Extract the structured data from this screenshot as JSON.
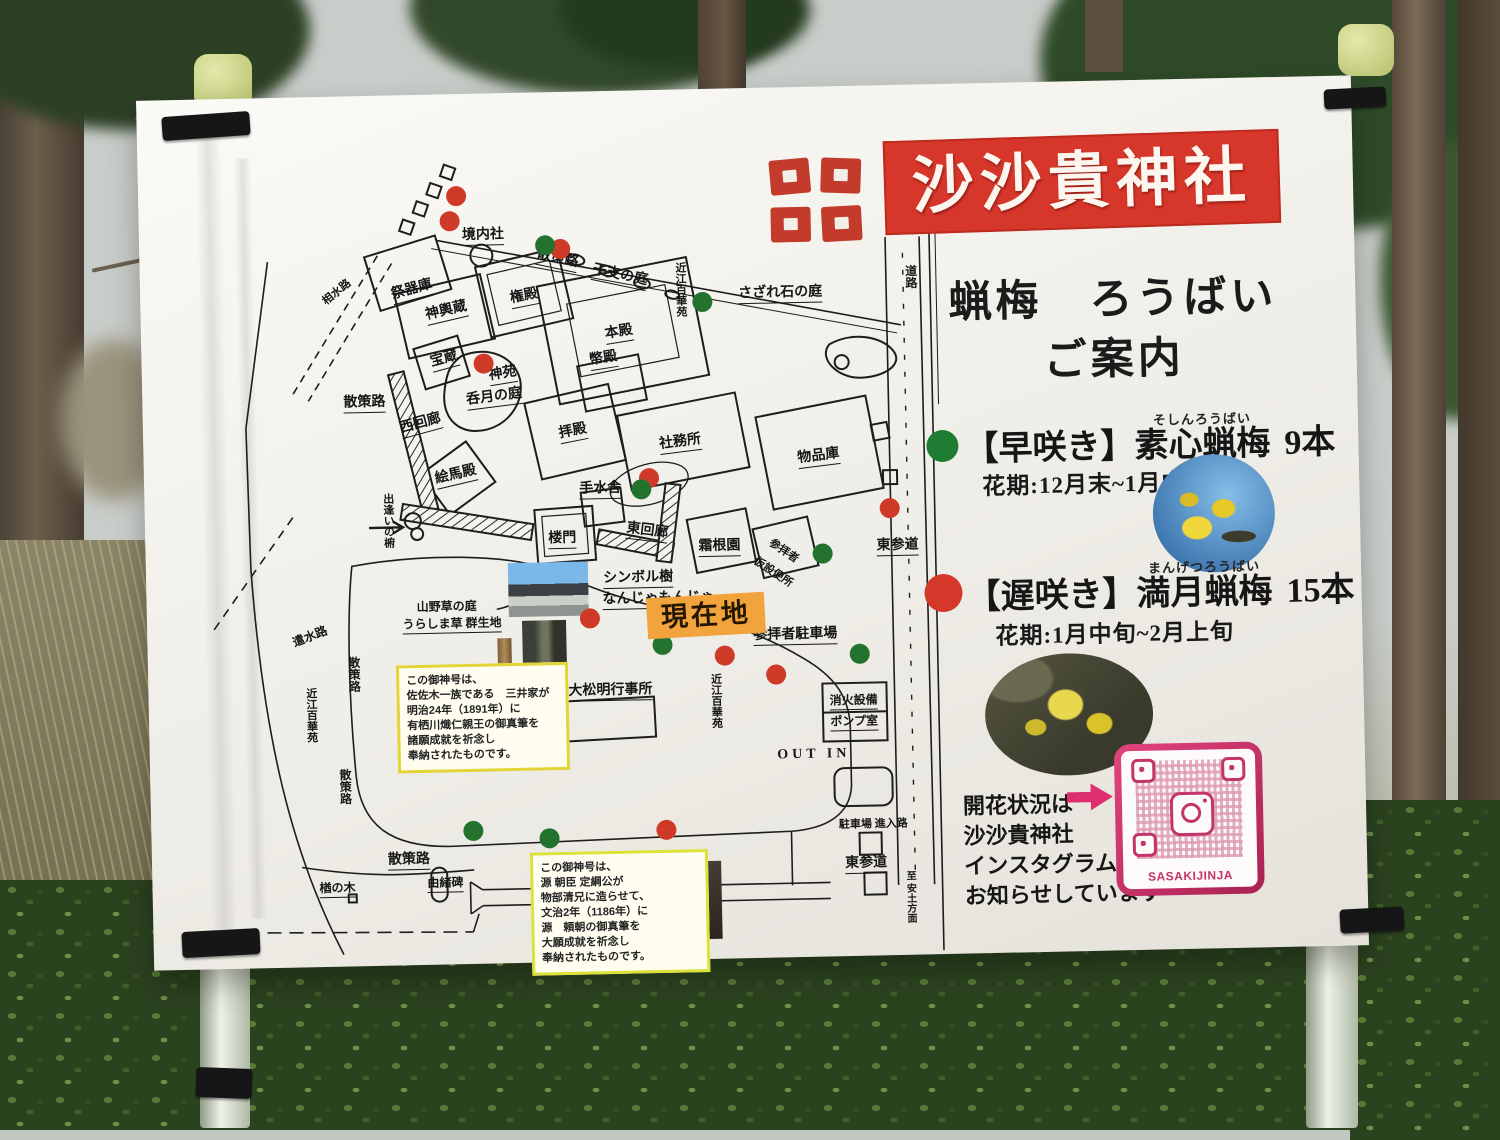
{
  "board": {
    "title": "沙沙貴神社",
    "guide_line1": "蝋梅　ろうばい",
    "guide_line2": "ご案内",
    "legend": [
      {
        "label": "【早咲き】",
        "name": "素心蝋梅",
        "furigana": "そしんろうばい",
        "count": "9本",
        "period": "花期:12月末~1月中旬",
        "dot_color": "#1e7d33"
      },
      {
        "label": "【遅咲き】",
        "name": "満月蝋梅",
        "furigana": "まんげつろうばい",
        "count": "15本",
        "period": "花期:1月中旬~2月上旬",
        "dot_color": "#d4382a"
      }
    ],
    "instagram": {
      "line1": "開花状況は",
      "line2": "沙沙貴神社",
      "line3": "インスタグラムで",
      "line4": "お知らせしています",
      "qr_caption": "SASAKIJINJA"
    },
    "colors": {
      "banner_red": "#d7362b",
      "accent_pink": "#dd2f6e",
      "marker_orange": "#f1a33c",
      "note_yellow": "#e3d437"
    }
  },
  "map": {
    "current_location": "現在地",
    "labels": [
      {
        "t": "祭器庫",
        "x": 272,
        "y": 196,
        "r": -14,
        "u": 1
      },
      {
        "t": "境内社",
        "x": 344,
        "y": 143,
        "u": 1
      },
      {
        "t": "散策路",
        "x": 418,
        "y": 168,
        "r": 13,
        "u": 1
      },
      {
        "t": "干支の庭",
        "x": 480,
        "y": 186,
        "r": 13,
        "u": 1
      },
      {
        "t": "近江百華苑",
        "x": 540,
        "y": 200,
        "v": 1,
        "s": 11
      },
      {
        "t": "さざれ石の庭",
        "x": 640,
        "y": 207,
        "u": 1
      },
      {
        "t": "神輿蔵",
        "x": 306,
        "y": 218,
        "r": -12,
        "u": 1
      },
      {
        "t": "権殿",
        "x": 384,
        "y": 205,
        "r": -10,
        "u": 1
      },
      {
        "t": "本殿",
        "x": 478,
        "y": 243,
        "r": -8,
        "u": 1
      },
      {
        "t": "幣殿",
        "x": 462,
        "y": 269,
        "r": -8,
        "u": 1
      },
      {
        "t": "宝蔵",
        "x": 303,
        "y": 266,
        "r": -14,
        "u": 1
      },
      {
        "t": "神苑",
        "x": 361,
        "y": 282,
        "r": -8,
        "u": 1
      },
      {
        "t": "呑月の庭",
        "x": 352,
        "y": 305,
        "r": -6,
        "u": 1
      },
      {
        "t": "西回廊",
        "x": 278,
        "y": 330,
        "r": -14,
        "u": 1
      },
      {
        "t": "散策路",
        "x": 222,
        "y": 308,
        "u": 1
      },
      {
        "t": "相水路",
        "x": 197,
        "y": 196,
        "r": -38,
        "s": 11
      },
      {
        "t": "拝殿",
        "x": 430,
        "y": 341,
        "r": -10,
        "u": 1
      },
      {
        "t": "絵馬殿",
        "x": 312,
        "y": 382,
        "r": -12,
        "u": 1
      },
      {
        "t": "手水舎",
        "x": 456,
        "y": 399,
        "u": 1
      },
      {
        "t": "社務所",
        "x": 537,
        "y": 354,
        "r": -6,
        "u": 1
      },
      {
        "t": "物品庫",
        "x": 675,
        "y": 371,
        "r": -6,
        "u": 1
      },
      {
        "t": "東回廊",
        "x": 502,
        "y": 442,
        "r": 8,
        "u": 1
      },
      {
        "t": "楼門",
        "x": 417,
        "y": 448,
        "u": 1
      },
      {
        "t": "霜根園",
        "x": 574,
        "y": 459,
        "u": 1
      },
      {
        "t": "参拝者",
        "x": 638,
        "y": 464,
        "r": 35,
        "s": 11
      },
      {
        "t": "仮設便所",
        "x": 627,
        "y": 485,
        "r": 35,
        "s": 11
      },
      {
        "t": "東参道",
        "x": 752,
        "y": 462,
        "u": 1
      },
      {
        "t": "シンボル樹",
        "x": 492,
        "y": 489,
        "u": 1
      },
      {
        "t": "なんじゃもんじゃ",
        "x": 512,
        "y": 510,
        "u": 1
      },
      {
        "t": "参拝者駐車場",
        "x": 648,
        "y": 549,
        "u": 1
      },
      {
        "t": "大松明行事所",
        "x": 462,
        "y": 601,
        "u": 1
      },
      {
        "t": "山野草の庭",
        "x": 300,
        "y": 513,
        "s": 12
      },
      {
        "t": "うらしま草 群生地",
        "x": 305,
        "y": 531,
        "s": 12,
        "u": 1
      },
      {
        "t": "出逢いの椨",
        "x": 243,
        "y": 425,
        "v": 1,
        "s": 11
      },
      {
        "t": "遣水路",
        "x": 163,
        "y": 540,
        "r": -20,
        "s": 12
      },
      {
        "t": "近江百華苑",
        "x": 162,
        "y": 618,
        "v": 1,
        "s": 11
      },
      {
        "t": "散策路",
        "x": 205,
        "y": 578,
        "v": 1,
        "s": 12
      },
      {
        "t": "散策路",
        "x": 194,
        "y": 690,
        "v": 1,
        "s": 12
      },
      {
        "t": "近江百華苑",
        "x": 567,
        "y": 612,
        "v": 1,
        "s": 11
      },
      {
        "t": "消火設備",
        "x": 705,
        "y": 616,
        "u": 1,
        "s": 12
      },
      {
        "t": "ポンプ室",
        "x": 705,
        "y": 637,
        "u": 1,
        "s": 12
      },
      {
        "t": "OUT IN",
        "x": 664,
        "y": 668,
        "s": 14,
        "sp": 1
      },
      {
        "t": "駐車場 進入路",
        "x": 722,
        "y": 739,
        "s": 11
      },
      {
        "t": "散策路",
        "x": 257,
        "y": 766,
        "u": 1
      },
      {
        "t": "楢の木",
        "x": 185,
        "y": 793,
        "u": 1,
        "s": 12
      },
      {
        "t": "由緒碑",
        "x": 293,
        "y": 790,
        "u": 1,
        "s": 12
      },
      {
        "t": "東参道",
        "x": 714,
        "y": 779,
        "u": 1
      },
      {
        "t": "道路",
        "x": 770,
        "y": 192,
        "v": 1,
        "s": 12
      },
      {
        "t": "至 安土方面",
        "x": 757,
        "y": 812,
        "v": 1,
        "s": 10
      }
    ],
    "notes": [
      {
        "lines": [
          "この御神号は、",
          "佐佐木一族である　三井家が",
          "明治24年（1891年）に",
          "有栖川熾仁親王の御真筆を",
          "諸願成就を祈念し",
          "奉納されたものです。"
        ]
      },
      {
        "lines": [
          "この御神号は、",
          "源 朝臣 定綱公が",
          "物部清兄に造らせて、",
          "文治2年（1186年）に",
          "源　頼朝の御真筆を",
          "大願成就を祈念し",
          "奉納されたものです。"
        ]
      }
    ],
    "dots": [
      {
        "x": 318,
        "y": 102,
        "c": "r"
      },
      {
        "x": 311,
        "y": 127,
        "c": "r"
      },
      {
        "x": 421,
        "y": 157,
        "c": "r"
      },
      {
        "x": 406,
        "y": 153,
        "c": "g"
      },
      {
        "x": 342,
        "y": 270,
        "c": "r"
      },
      {
        "x": 562,
        "y": 213,
        "c": "g"
      },
      {
        "x": 505,
        "y": 388,
        "c": "r"
      },
      {
        "x": 497,
        "y": 399,
        "c": "g"
      },
      {
        "x": 745,
        "y": 423,
        "c": "r"
      },
      {
        "x": 677,
        "y": 467,
        "c": "g"
      },
      {
        "x": 443,
        "y": 527,
        "c": "r"
      },
      {
        "x": 515,
        "y": 555,
        "c": "g"
      },
      {
        "x": 577,
        "y": 567,
        "c": "r"
      },
      {
        "x": 628,
        "y": 587,
        "c": "r"
      },
      {
        "x": 712,
        "y": 568,
        "c": "g"
      },
      {
        "x": 322,
        "y": 737,
        "c": "g"
      },
      {
        "x": 398,
        "y": 746,
        "c": "g"
      },
      {
        "x": 515,
        "y": 740,
        "c": "r"
      }
    ]
  }
}
